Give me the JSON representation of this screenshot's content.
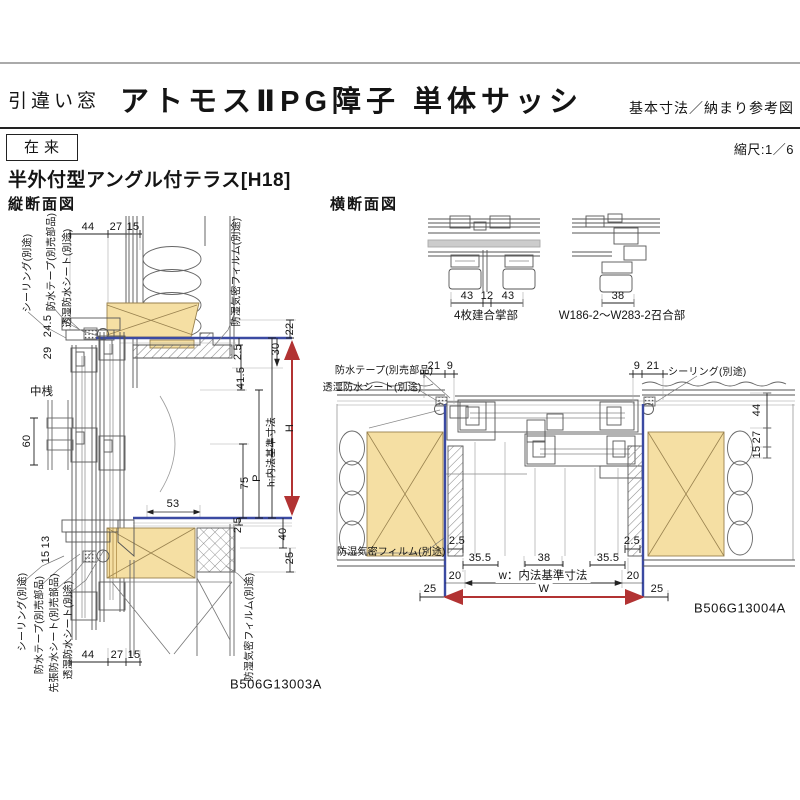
{
  "header": {
    "window_type": "引違い窓",
    "title": "アトモスⅡPG障子 単体サッシ",
    "right_note": "基本寸法／納まり参考図",
    "method_badge": "在来",
    "scale": "縮尺:1／6",
    "heading": "半外付型アングル付テラス[H18]"
  },
  "vertical_section": {
    "title": "縦断面図",
    "code": "B506G13003A",
    "top_dims": [
      "44",
      "27",
      "15"
    ],
    "bottom_dims": [
      "44",
      "27",
      "15"
    ],
    "upper_labels": [
      "シーリング(別途)",
      "防水テープ(別売部品)",
      "透湿防水シート(別途)",
      "防湿気密フィルム(別途)"
    ],
    "lower_labels": [
      "シーリング(別途)",
      "防水テープ(別売部品)",
      "先張防水シート(別売部品)",
      "透湿防水シート(別途)",
      "防湿気密フィルム(別途)"
    ],
    "left_dims": {
      "d24_5": "24.5",
      "d29": "29",
      "d60": "60",
      "d13": "13",
      "d15": "15"
    },
    "mid_rail_label": "中桟",
    "right_dims": {
      "d22": "22",
      "d2_5_top": "2.5",
      "d30": "30",
      "d41_5": "41.5",
      "d53": "53",
      "d75": "75",
      "p": "P",
      "h_label": "h:内法基準寸法",
      "H": "H",
      "d2_5_bottom": "2.5",
      "d40": "40",
      "d25": "25"
    }
  },
  "horizontal_section": {
    "title": "横断面図",
    "code": "B506G13004A",
    "details": [
      {
        "caption": "4枚建合掌部",
        "dims": [
          "43",
          "12",
          "43"
        ]
      },
      {
        "caption": "W186-2〜W283-2召合部",
        "dims": [
          "38"
        ]
      }
    ],
    "top_left_labels": [
      "防水テープ(別売部品)",
      "透湿防水シート(別途)"
    ],
    "top_left_dims": [
      "21",
      "9"
    ],
    "top_right_dims": [
      "9",
      "21"
    ],
    "top_right_label": "シーリング(別途)",
    "right_edge_dims": [
      "44",
      "27",
      "15"
    ],
    "bottom_left_label": "防湿気密フィルム(別途)",
    "bottom_dims": {
      "left_2_5": "2.5",
      "right_2_5": "2.5",
      "left_35_5": "35.5",
      "center_38": "38",
      "right_35_5": "35.5",
      "left_20": "20",
      "right_20": "20",
      "left_25": "25",
      "right_25": "25",
      "w_label": "w：内法基準寸法",
      "W": "W"
    }
  },
  "colors": {
    "wood": "#f5dfa3",
    "dim_red": "#b23333",
    "ref_blue": "#3b4aa2"
  }
}
